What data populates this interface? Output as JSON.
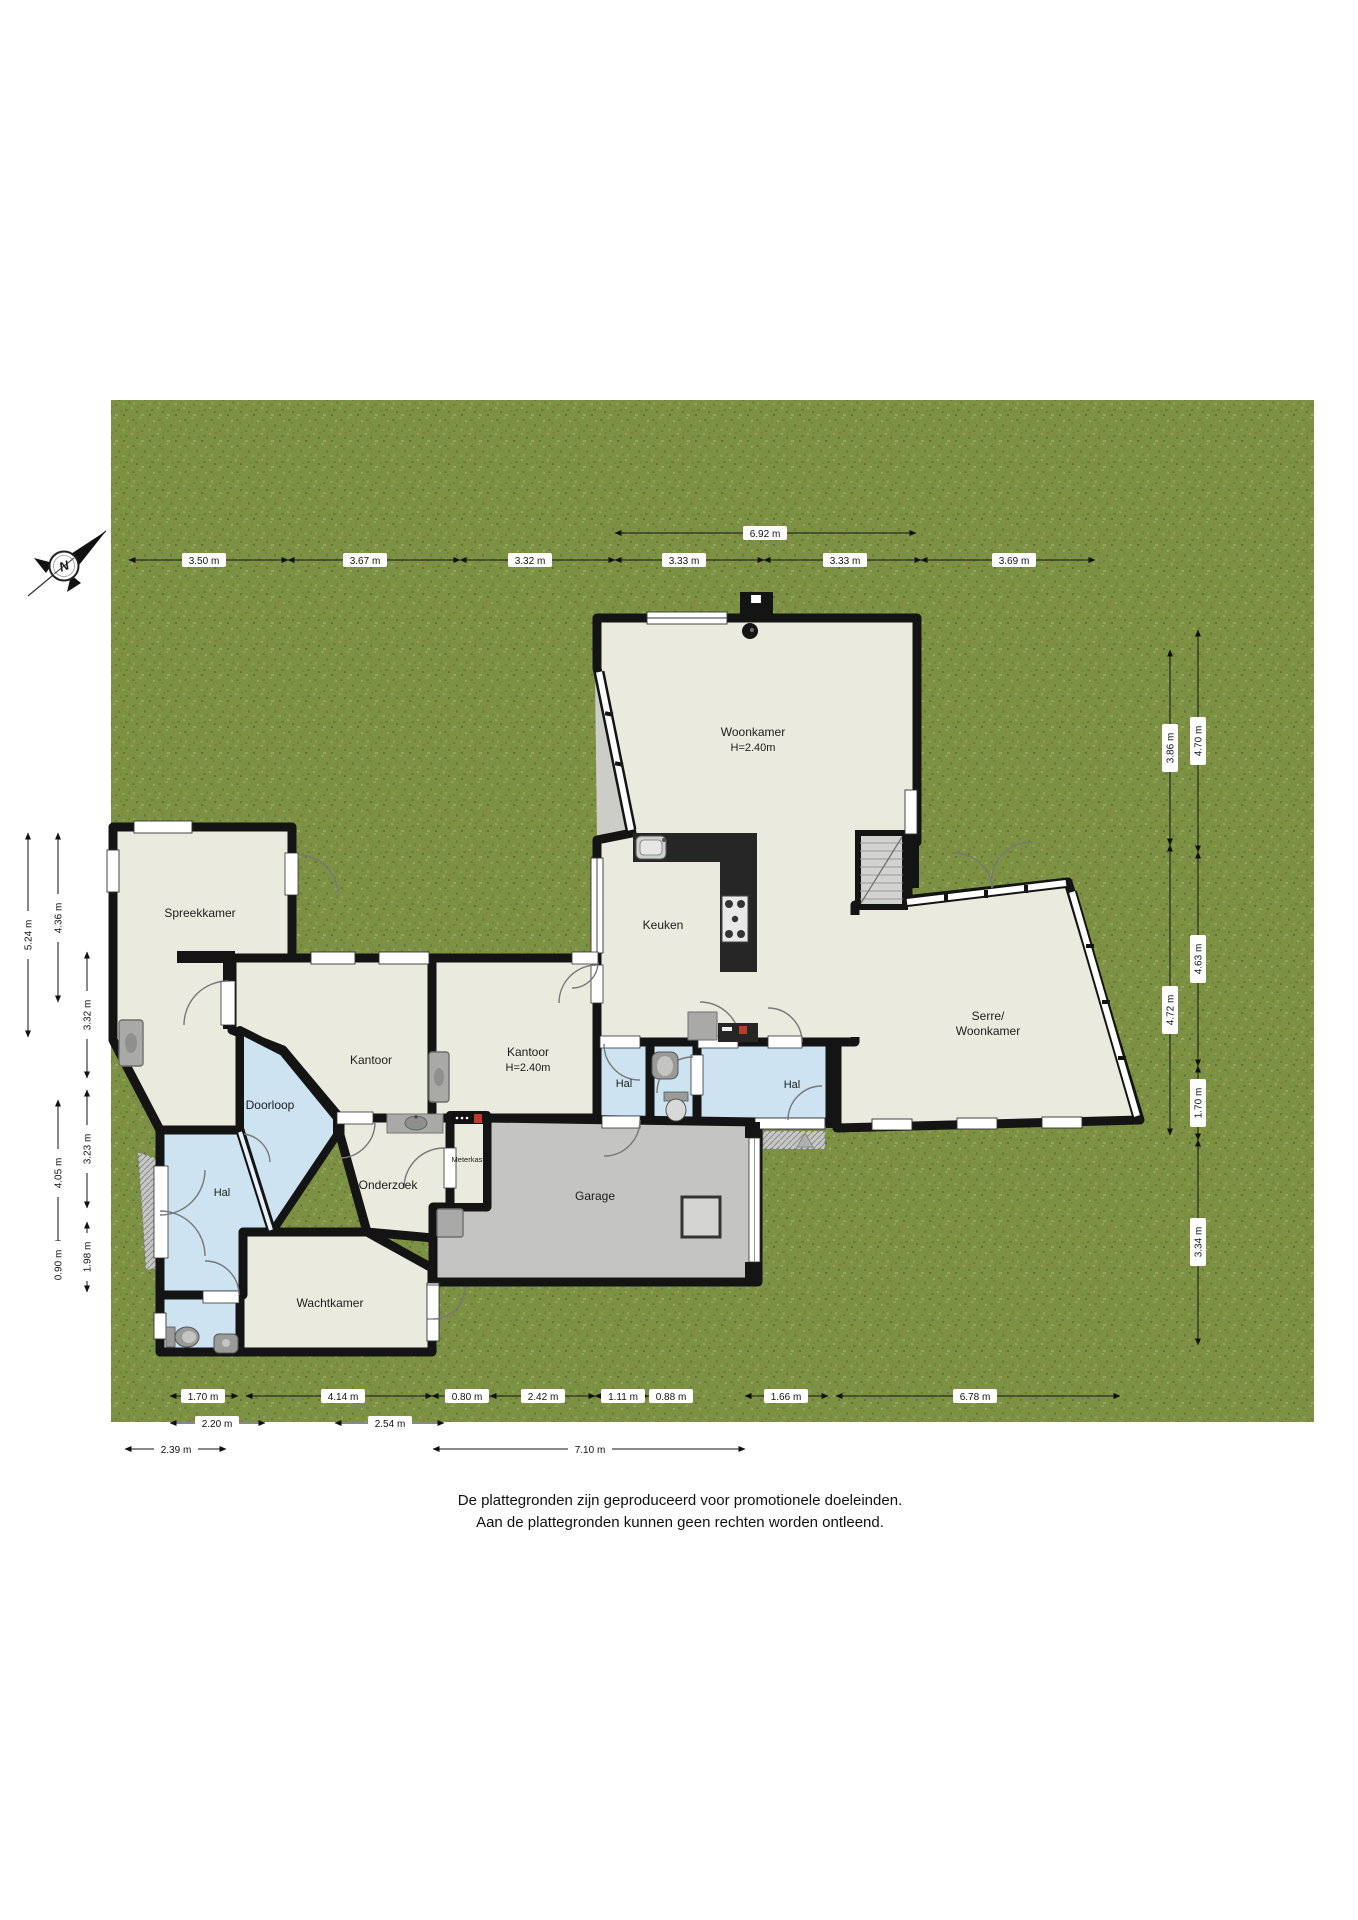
{
  "fp": {
    "compass": {
      "label": "N"
    },
    "rooms": {
      "woonkamer": {
        "label": "Woonkamer",
        "height": "H=2.40m"
      },
      "keuken": {
        "label": "Keuken"
      },
      "serre": {
        "line1": "Serre/",
        "line2": "Woonkamer"
      },
      "spreekkamer": {
        "label": "Spreekkamer"
      },
      "kantoor": {
        "label": "Kantoor"
      },
      "kantoor2": {
        "label": "Kantoor",
        "height": "H=2.40m"
      },
      "doorloop": {
        "label": "Doorloop"
      },
      "hal_entree": {
        "label": "Hal"
      },
      "hal_west": {
        "label": "Hal"
      },
      "hal_east": {
        "label": "Hal"
      },
      "onderzoek": {
        "label": "Onderzoek"
      },
      "meterkast": {
        "label": "Meterkast"
      },
      "garage": {
        "label": "Garage"
      },
      "wachtkamer": {
        "label": "Wachtkamer"
      }
    },
    "dims": {
      "top": [
        "6.92 m",
        "3.50 m",
        "3.67 m",
        "3.32 m",
        "3.33 m",
        "3.33 m",
        "3.69 m"
      ],
      "left": [
        "5.24 m",
        "4.36 m",
        "3.32 m",
        "3.23 m",
        "4.05 m",
        "1.98 m",
        "0.90 m"
      ],
      "right": [
        "4.70 m",
        "3.86 m",
        "4.63 m",
        "4.72 m",
        "1.70 m",
        "3.34 m"
      ],
      "bottom1": [
        "1.70 m",
        "4.14 m",
        "0.80 m",
        "2.42 m",
        "1.11 m",
        "0.88 m",
        "1.66 m",
        "6.78 m"
      ],
      "bottom2": [
        "2.20 m",
        "2.54 m"
      ],
      "bottom3": [
        "2.39 m",
        "7.10 m"
      ]
    },
    "footer": {
      "line1": "De plattegronden zijn geproduceerd voor promotionele doeleinden.",
      "line2": "Aan de plattegronden kunnen geen rechten worden ontleend."
    },
    "colors": {
      "grass": "#7d9144",
      "floor": "#eaeadf",
      "hall_floor": "#cde3f2",
      "garage_floor": "#c4c4c2",
      "stairs": "#d2d2d0",
      "wall": "#141414",
      "counter": "#262626",
      "accent_red": "#c0392b"
    }
  }
}
